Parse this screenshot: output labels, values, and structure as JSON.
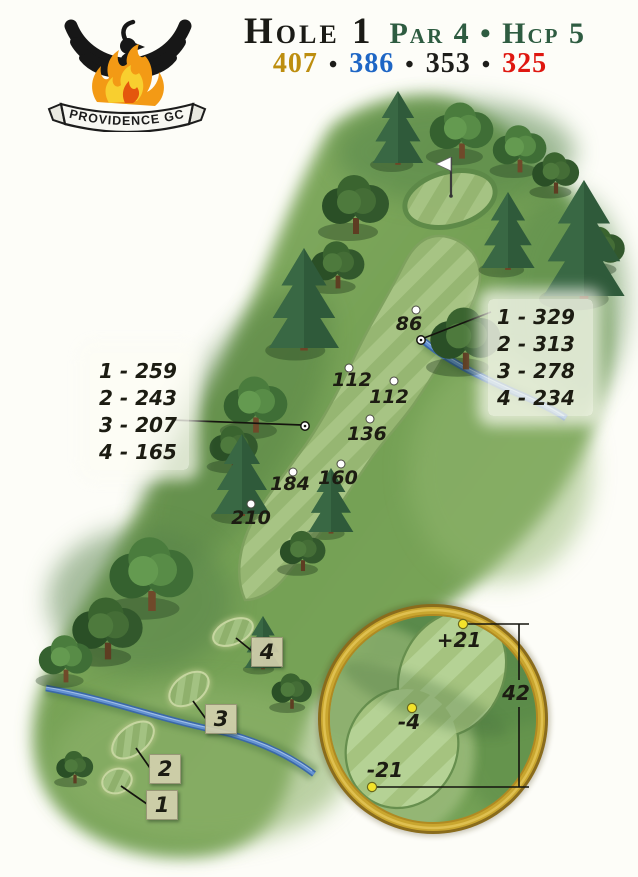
{
  "logo": {
    "club_name": "PROVIDENCE GC"
  },
  "header": {
    "hole": "Hole 1",
    "par_hcp": "Par 4 • Hcp 5",
    "separator": "•",
    "tees": [
      {
        "name": "gold",
        "yards": "407",
        "color": "#bd8e0f"
      },
      {
        "name": "blue",
        "yards": "386",
        "color": "#1e66c5"
      },
      {
        "name": "black",
        "yards": "353",
        "color": "#1d1d1a"
      },
      {
        "name": "red",
        "yards": "325",
        "color": "#df1710"
      }
    ]
  },
  "map": {
    "yardage_markers": [
      "86",
      "112",
      "112",
      "136",
      "160",
      "184",
      "210"
    ],
    "left_callout": [
      "1 - 259",
      "2 - 243",
      "3 - 207",
      "4 - 165"
    ],
    "right_callout": [
      "1 - 329",
      "2 - 313",
      "3 - 278",
      "4 - 234"
    ],
    "tee_labels": [
      "4",
      "3",
      "2",
      "1"
    ]
  },
  "green_inset": {
    "back_offset": "+21",
    "center_offset": "-4",
    "front_offset": "-21",
    "depth": "42"
  },
  "colors": {
    "rough_green": "#7aa45a",
    "fairway_light": "#a9c686",
    "fairway_dark": "#98b773",
    "creek_blue": "#3b69a8",
    "inset_rim_gold": "#c9a62f",
    "depth_dot_yellow": "#f3e32b",
    "title_green": "#2e5c41"
  }
}
